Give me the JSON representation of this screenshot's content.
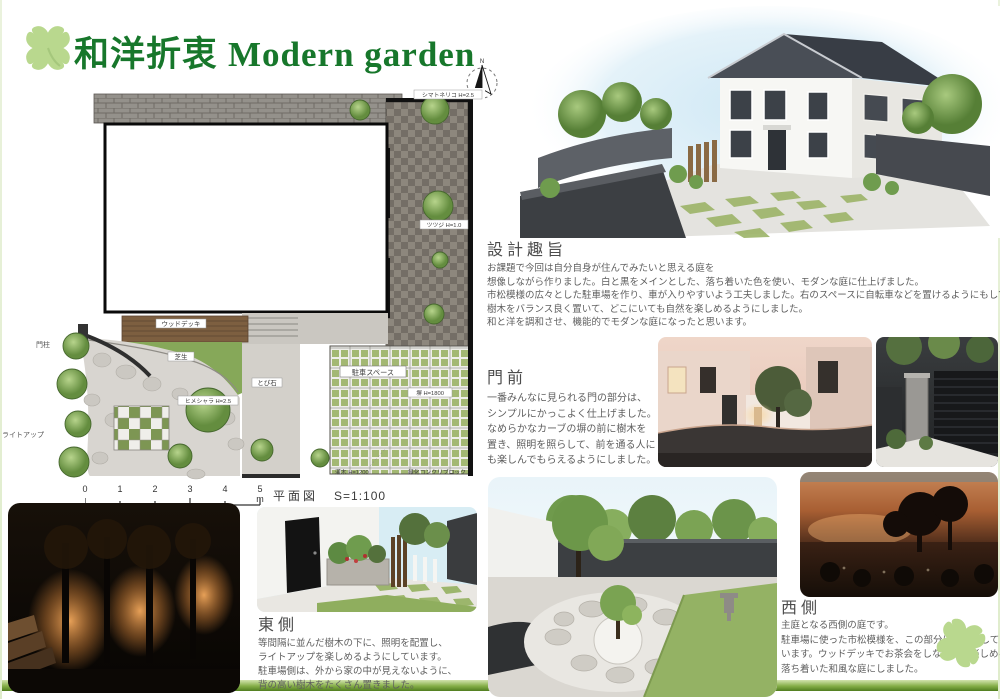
{
  "header": {
    "title_jp": "和洋折衷",
    "title_en": "Modern garden",
    "compass_n": "N"
  },
  "plan": {
    "caption": "平面図",
    "scale": "S=1:100",
    "ticks": [
      "0",
      "1",
      "2",
      "3",
      "4",
      "5 m"
    ],
    "labels": {
      "deck": "ウッドデッキ",
      "lawn": "芝生",
      "stepping": "とび石",
      "tree_center": "ヒメシャラ H=2.5",
      "tree_right": "シマトネリコ H=2.5",
      "azalea": "ツツジ H=1.0",
      "parking": "駐車スペース",
      "wall": "塀 H=1800",
      "shrub": "灌木 H=1200",
      "greenblock": "緑化コンクリブロック",
      "gatepost": "門柱",
      "lightup": "ライトアップ"
    }
  },
  "sections": {
    "concept": {
      "heading": "設計趣旨",
      "lines": [
        "お課題で今回は自分自身が住んでみたいと思える庭を",
        "想像しながら作りました。白と黒をメインとした、落ち着いた色を使い、モダンな庭に仕上げました。",
        "市松模様の広々とした駐車場を作り、車が入りやすいよう工夫しました。右のスペースに自転車などを置けるようにもしています。",
        "樹木をバランス良く置いて、どこにいても自然を楽しめるようにしました。",
        "和と洋を調和させ、機能的でモダンな庭になったと思います。"
      ]
    },
    "gate": {
      "heading": "門前",
      "lines": [
        "一番みんなに見られる門の部分は、",
        "シンプルにかっこよく仕上げました。",
        "なめらかなカーブの塀の前に樹木を",
        "置き、照明を照らして、前を通る人に",
        "も楽しんでもらえるようにしました。"
      ]
    },
    "east": {
      "heading": "東側",
      "lines": [
        "等間隔に並んだ樹木の下に、照明を配置し、",
        "ライトアップを楽しめるようにしています。",
        "駐車場側は、外から家の中が見えないように、",
        "背の高い樹木をたくさん置きました。"
      ]
    },
    "west": {
      "heading": "西側",
      "lines": [
        "主庭となる西側の庭です。",
        "駐車場に使った市松模様を、この部分にも使用して",
        "います。ウッドデッキでお茶会をしながら、楽しめる",
        "落ち着いた和風な庭にしました。"
      ]
    }
  },
  "colors": {
    "title_green": "#17772b",
    "clover_green": "#b9d88e",
    "bar_dark": "#558422",
    "bar_light": "#dcead0"
  }
}
